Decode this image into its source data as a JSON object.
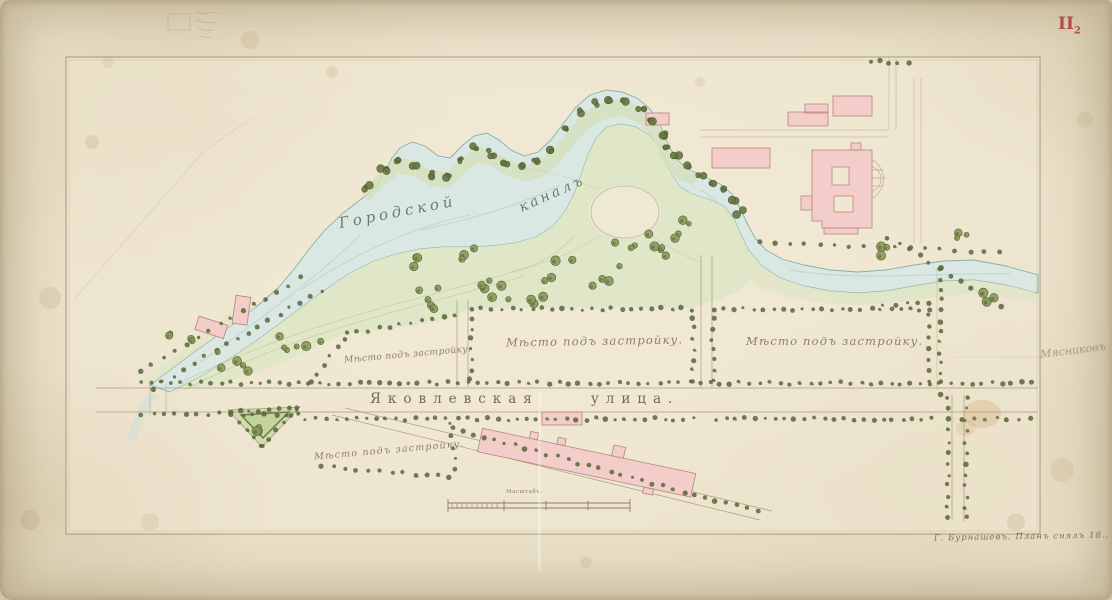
{
  "sheet": {
    "number_main": "II",
    "number_sub": "2"
  },
  "labels": {
    "canal_name_part1": "Городской",
    "canal_name_part2": "каналъ",
    "street_name_part1": "Яковлевская",
    "street_name_part2": "улица.",
    "plots": [
      "Мѣсто подъ застройку.",
      "Мѣсто подъ застройку.",
      "Мѣсто подъ застройку.",
      "Мѣсто подъ застройку."
    ],
    "scale": "Масштабъ.",
    "signature": "Г. Бурнашевъ.  Планъ снялъ 18..",
    "pencil_note": "Мясниковъ"
  },
  "colors": {
    "paper": "#e9e0c8",
    "water": "#d9e8e4",
    "park_green": "#dde6c5",
    "building_pink": "#f2cdc9",
    "ink": "#9b8a6c",
    "tree_green": "#57653b",
    "accent_red": "#b23f38"
  }
}
